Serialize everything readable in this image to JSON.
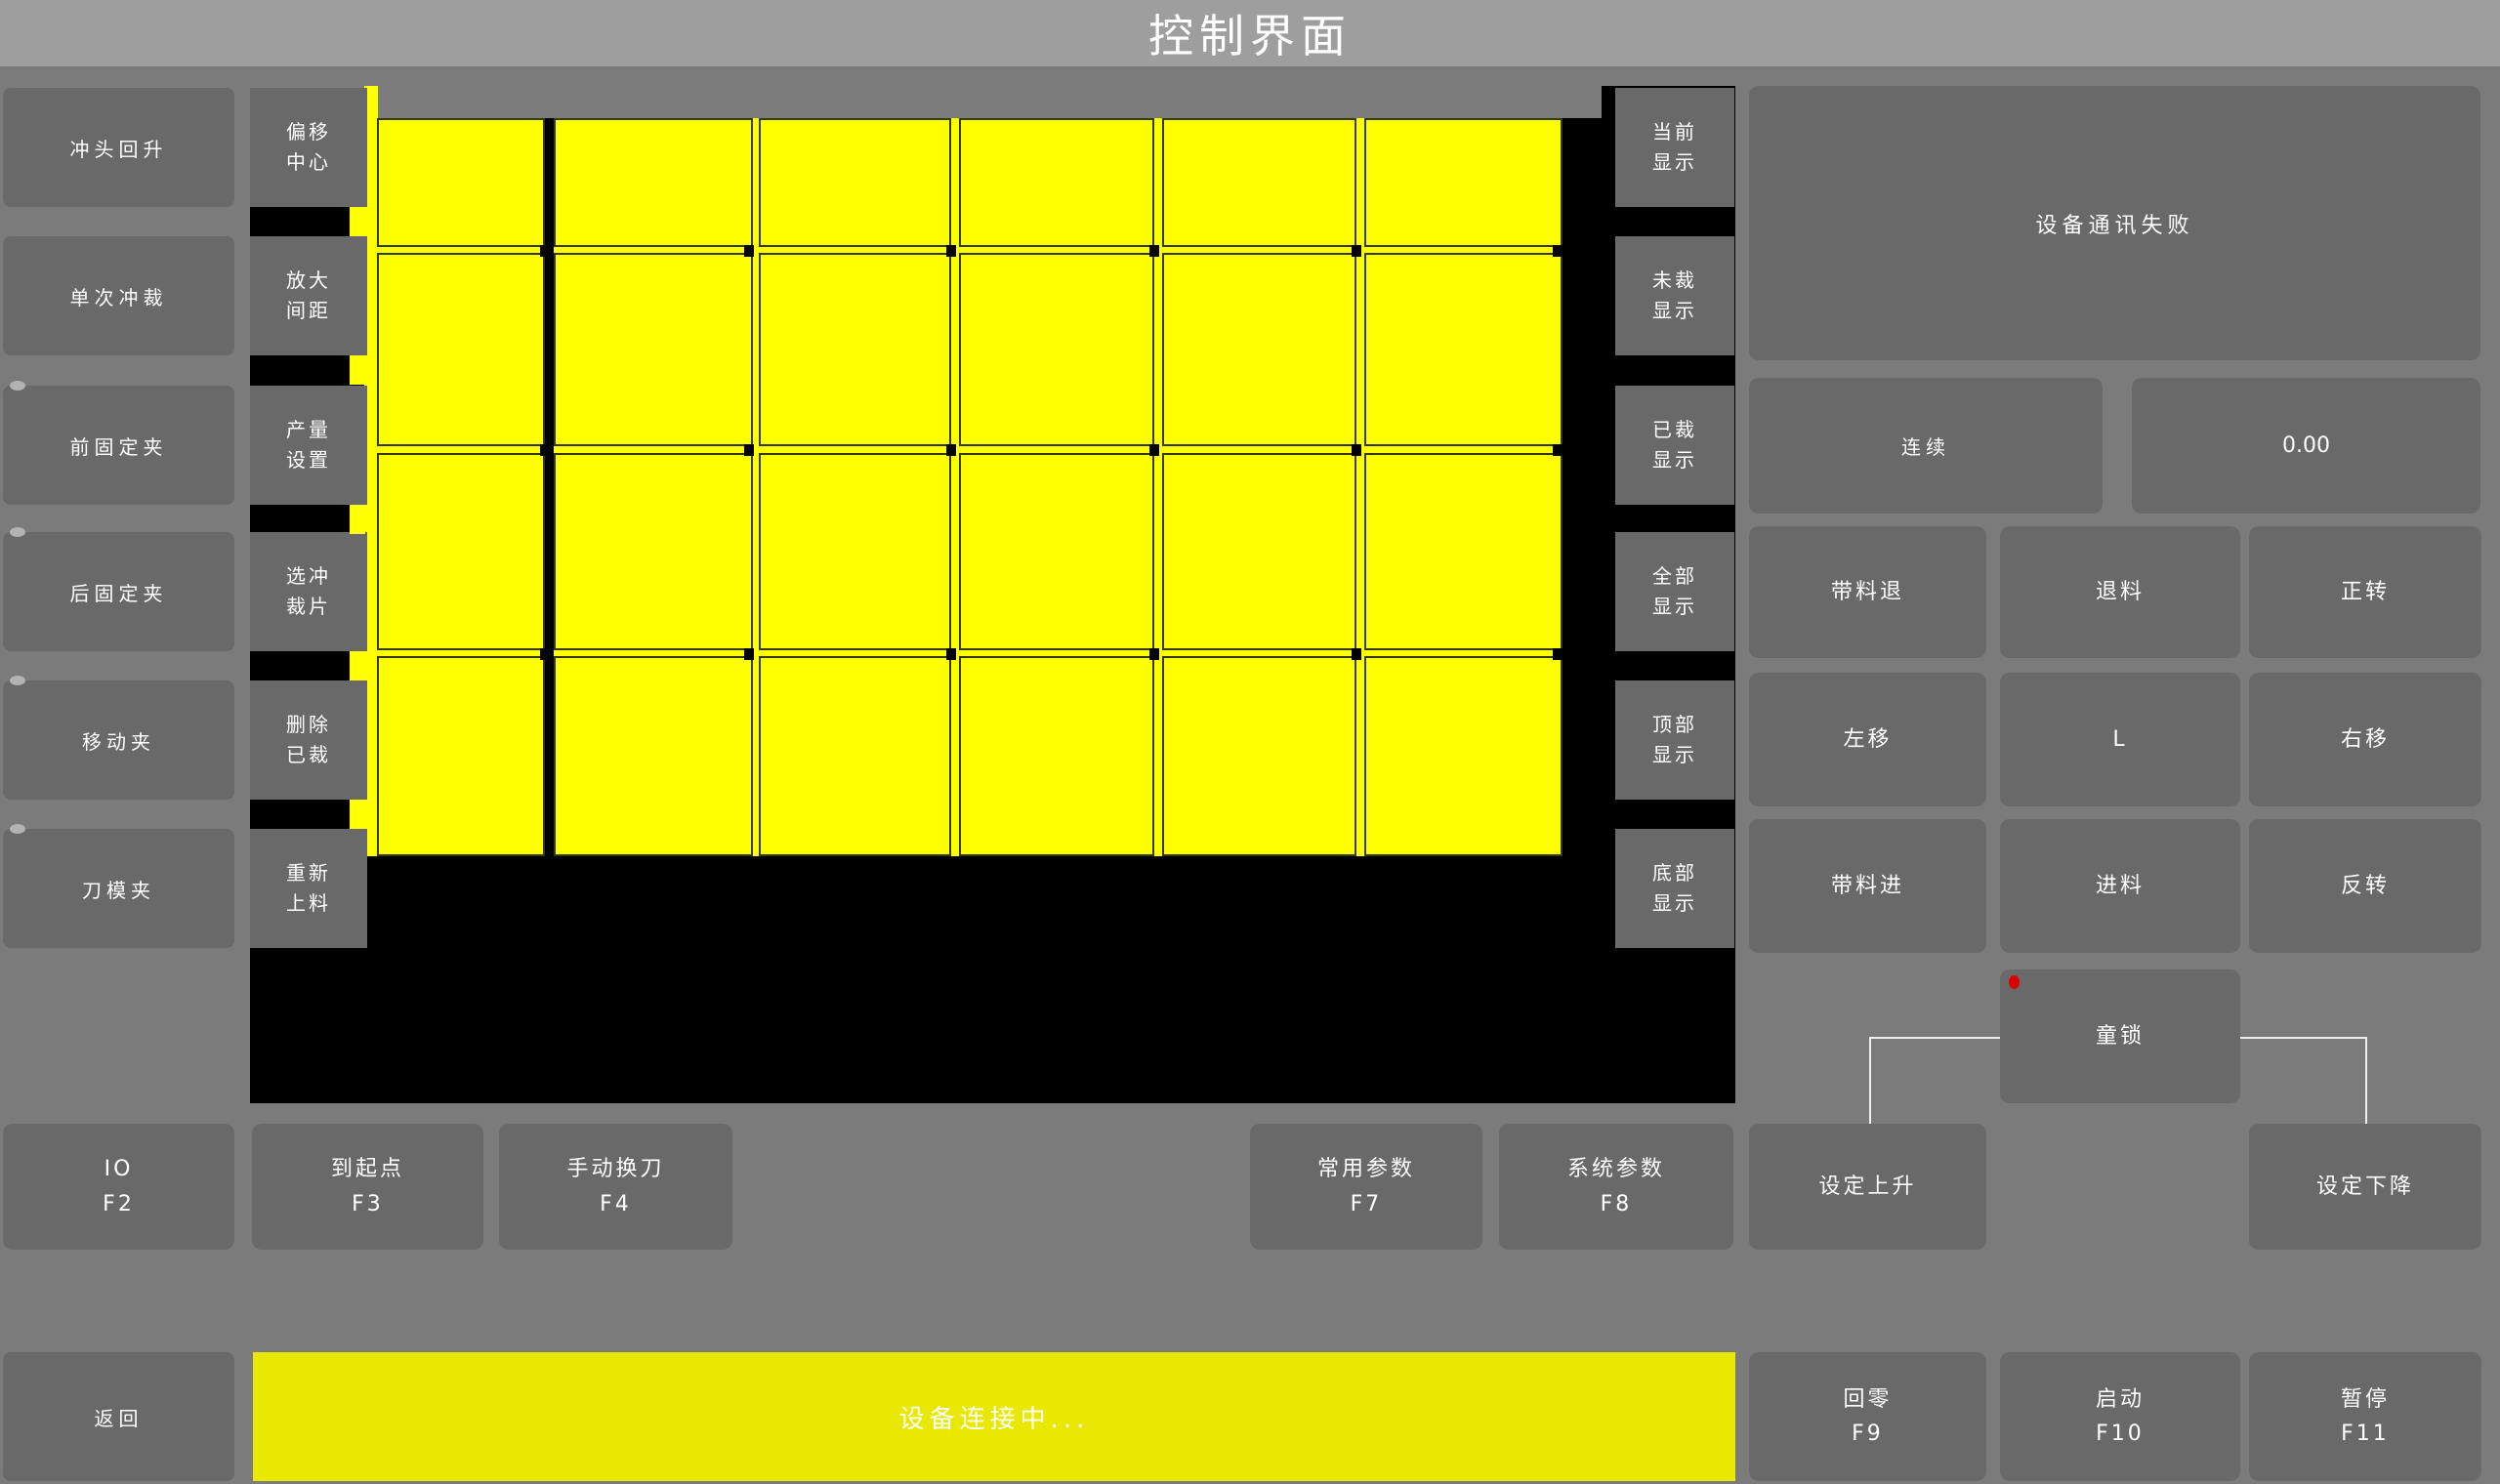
{
  "title": "控制界面",
  "left_panel": {
    "buttons": [
      {
        "label": "冲头回升",
        "indicator": false
      },
      {
        "label": "单次冲裁",
        "indicator": false
      },
      {
        "label": "前固定夹",
        "indicator": true
      },
      {
        "label": "后固定夹",
        "indicator": true
      },
      {
        "label": "移动夹",
        "indicator": true
      },
      {
        "label": "刀模夹",
        "indicator": true
      }
    ]
  },
  "tool_panel": {
    "buttons": [
      {
        "label": "偏移\n中心"
      },
      {
        "label": "放大\n间距"
      },
      {
        "label": "产量\n设置"
      },
      {
        "label": "选冲\n裁片"
      },
      {
        "label": "删除\n已裁"
      },
      {
        "label": "重新\n上料"
      }
    ]
  },
  "display_panel": {
    "buttons": [
      {
        "label": "当前\n显示"
      },
      {
        "label": "未裁\n显示"
      },
      {
        "label": "已裁\n显示"
      },
      {
        "label": "全部\n显示"
      },
      {
        "label": "顶部\n显示"
      },
      {
        "label": "底部\n显示"
      }
    ]
  },
  "canvas": {
    "grid_columns": 6,
    "grid_rows": 4
  },
  "status_panel": {
    "message": "设备通讯失败"
  },
  "mode_button": {
    "label": "连续"
  },
  "value_display": {
    "value": "0.00"
  },
  "jog_panel": {
    "buttons": [
      {
        "label": "带料退"
      },
      {
        "label": "退料"
      },
      {
        "label": "正转"
      },
      {
        "label": "左移"
      },
      {
        "label": "L"
      },
      {
        "label": "右移"
      },
      {
        "label": "带料进"
      },
      {
        "label": "进料"
      },
      {
        "label": "反转"
      }
    ]
  },
  "child_lock": {
    "label": "童锁"
  },
  "function_row": {
    "buttons": [
      {
        "label": "IO\nF2"
      },
      {
        "label": "到起点\nF3"
      },
      {
        "label": "手动换刀\nF4"
      },
      {
        "label": "常用参数\nF7"
      },
      {
        "label": "系统参数\nF8"
      },
      {
        "label": "设定上升"
      },
      {
        "label": "设定下降"
      }
    ]
  },
  "bottom_bar": {
    "back_label": "返回",
    "status_message": "设备连接中...",
    "buttons": [
      {
        "label": "回零\nF9"
      },
      {
        "label": "启动\nF10"
      },
      {
        "label": "暂停\nF11"
      }
    ]
  },
  "colors": {
    "background": "#7b7b7b",
    "titlebar": "#9e9e9e",
    "button_gray": "#696969",
    "canvas_black": "#000000",
    "piece_yellow": "#ffff00",
    "piece_border": "#2f3d02",
    "status_bar_yellow": "#e8e800",
    "alert_red": "#dd0000",
    "text": "#ffffff"
  }
}
